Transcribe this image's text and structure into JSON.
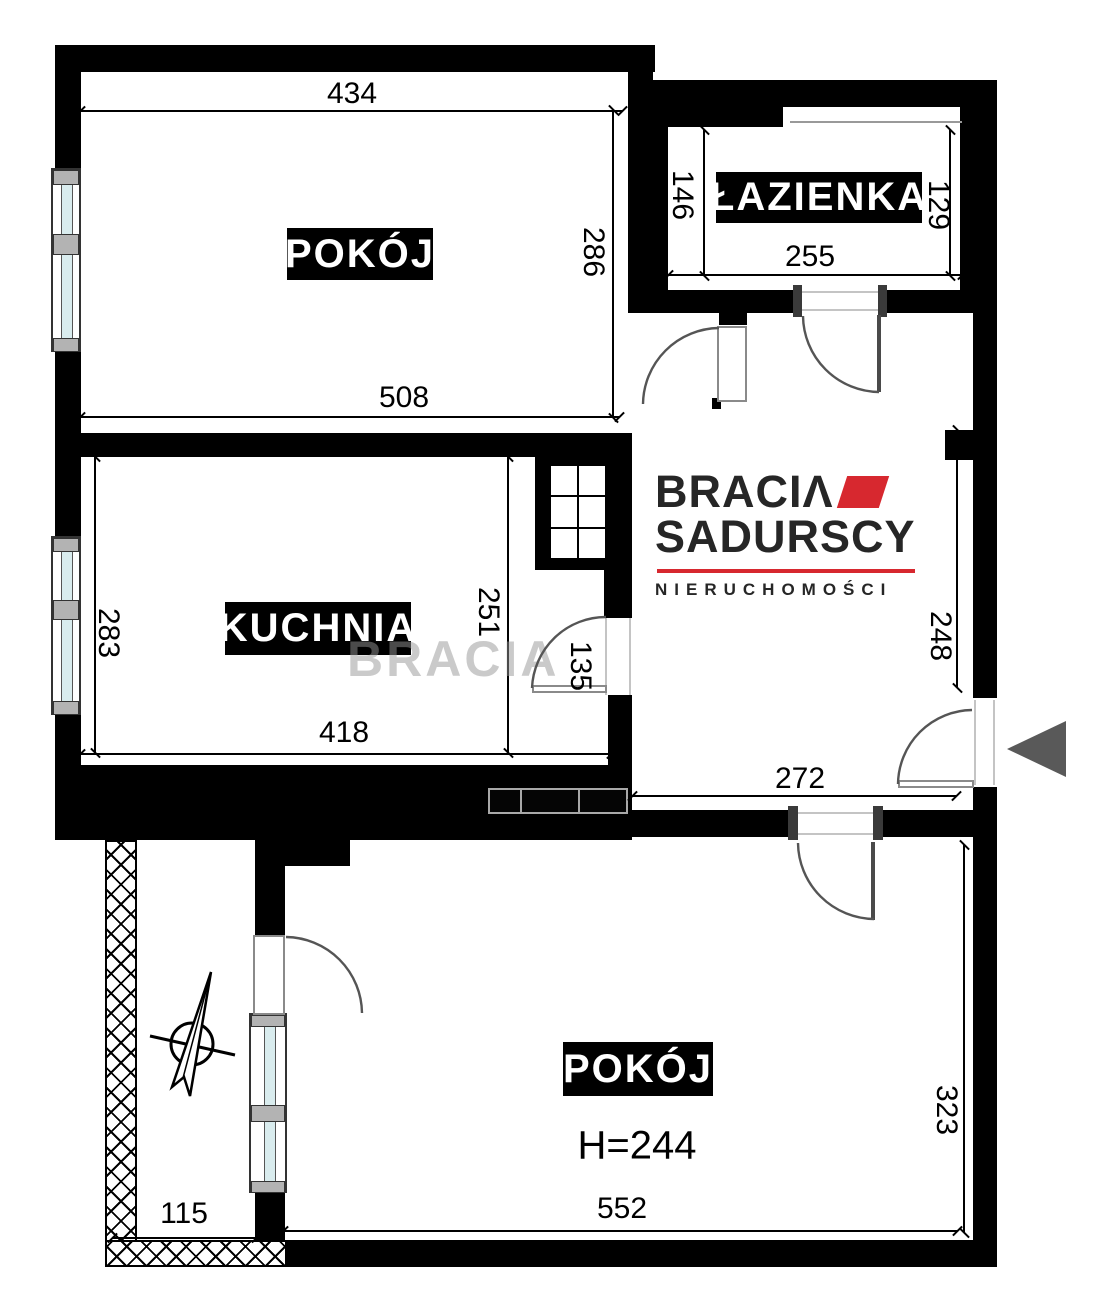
{
  "rooms": {
    "room_top": {
      "name": "POKÓJ"
    },
    "kitchen": {
      "name": "KUCHNIA"
    },
    "bathroom": {
      "name": "ŁAZIENKA"
    },
    "room_bottom": {
      "name": "POKÓJ",
      "ceiling_height": "H=244"
    }
  },
  "dimensions": {
    "room_top": {
      "width_top": "434",
      "height_right": "286",
      "width_bottom": "508"
    },
    "kitchen": {
      "height_left": "283",
      "height_right": "251",
      "width_bottom": "418",
      "door_width": "135"
    },
    "bathroom": {
      "height_left": "146",
      "height_right": "129",
      "width_bottom": "255"
    },
    "hall": {
      "height_right": "248",
      "width_bottom": "272"
    },
    "room_bottom": {
      "height_right": "323",
      "width_bottom": "552"
    },
    "balcony": {
      "width_bottom": "115"
    }
  },
  "logo": {
    "line1": "BRACIΛ",
    "line2": "SADURSCY",
    "line3": "NIERUCHOMOŚCI",
    "accent_color": "#d7282f",
    "text_color": "#262626"
  },
  "watermark": "BRACIA",
  "colors": {
    "wall": "#000000",
    "glass": "#d9ecee",
    "door_arc": "#555555",
    "entrance_arrow": "#595959"
  }
}
